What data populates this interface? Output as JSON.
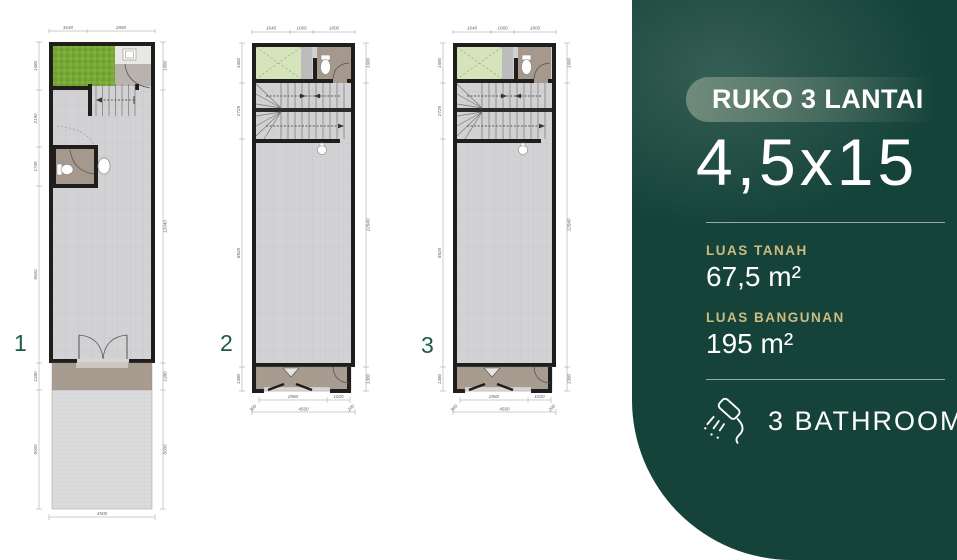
{
  "panel": {
    "badge": "RUKO 3 LANTAI",
    "size": "4,5x15",
    "land_label": "LUAS TANAH",
    "land_value": "67,5 m²",
    "building_label": "LUAS BANGUNAN",
    "building_value": "195 m²",
    "bathroom_count_label": "3 BATHROOM",
    "colors": {
      "background": "#15433a",
      "gold": "#cdbc82",
      "badge": "#7b9483",
      "text": "#ffffff"
    }
  },
  "plans": [
    {
      "label": "1",
      "dims": {
        "top": [
          "1640",
          "2860"
        ],
        "left": [
          "1680",
          "2150",
          "1735",
          "8600",
          "1280",
          "5000"
        ],
        "right": [
          "1680",
          "12040",
          "1280",
          "5000"
        ],
        "bottom": "4500"
      }
    },
    {
      "label": "2",
      "dims": {
        "top": [
          "1640",
          "1060",
          "1800"
        ],
        "left": [
          "1680",
          "2725",
          "8535",
          "1380"
        ],
        "right": [
          "1680",
          "12940",
          "1380"
        ],
        "bottom_inner": [
          "2980",
          "1020"
        ],
        "bottom_outer": [
          "300",
          "4500",
          "200"
        ]
      }
    },
    {
      "label": "3",
      "dims": {
        "top": [
          "1640",
          "1060",
          "1800"
        ],
        "left": [
          "1680",
          "2725",
          "8535",
          "1380"
        ],
        "right": [
          "1680",
          "12940",
          "1380"
        ],
        "bottom_inner": [
          "2980",
          "1020"
        ],
        "bottom_outer": [
          "300",
          "4500",
          "200"
        ]
      }
    }
  ],
  "colors": {
    "wall": "#201e1c",
    "tile_floor": "#d2d2d4",
    "terrace": "#a89b90",
    "carport": "#dcdcdd",
    "grass": "#76a936",
    "void_green": "#d5e4ba",
    "bath_floor": "#a5988d",
    "plan_number": "#1d5a4b",
    "dimension": "#666666"
  }
}
